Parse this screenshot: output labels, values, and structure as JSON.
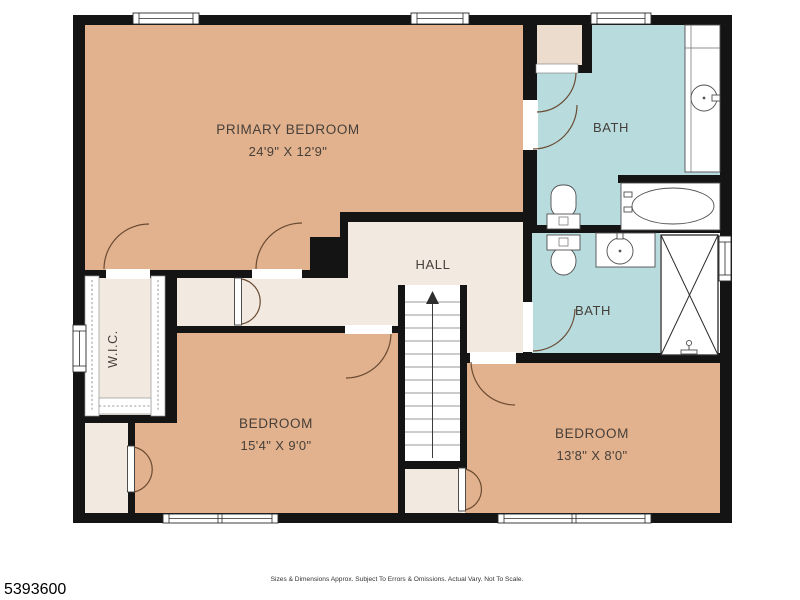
{
  "rooms": {
    "primary": {
      "label": "PRIMARY BEDROOM",
      "dims": "24'9\" X 12'9\""
    },
    "bath_top": {
      "label": "BATH"
    },
    "hall": {
      "label": "HALL"
    },
    "bath_mid": {
      "label": "BATH"
    },
    "wic": {
      "label": "W.I.C."
    },
    "bedroom_left": {
      "label": "BEDROOM",
      "dims": "15'4\" X 9'0\""
    },
    "bedroom_right": {
      "label": "BEDROOM",
      "dims": "13'8\" X 8'0\""
    }
  },
  "footer": {
    "listing_id": "5393600",
    "disclaimer": "Sizes & Dimensions Approx. Subject To Errors & Omissions. Actual Vary. Not To Scale."
  },
  "colors": {
    "bedroom_tan": "#e2b28e",
    "bath_blue": "#b8dbde",
    "hall_cream": "#f2e9e1",
    "closet_beige": "#ecdccd",
    "wall_black": "#141414",
    "door_arc_brown": "#6a4b32"
  }
}
